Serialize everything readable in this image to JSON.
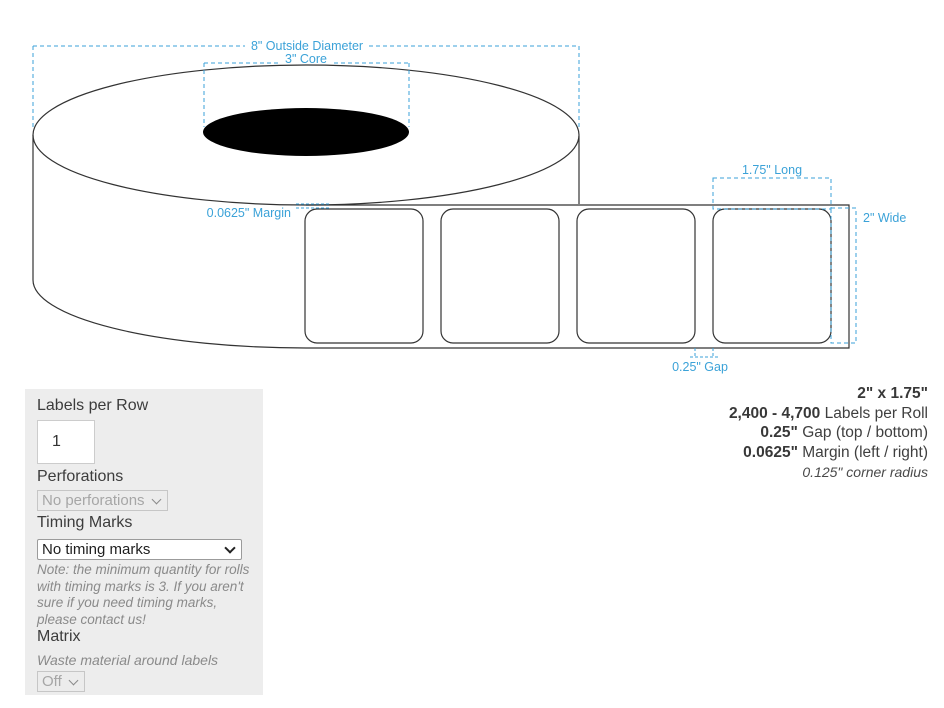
{
  "diagram": {
    "annotations": {
      "outside_diameter": "8\" Outside Diameter",
      "core": "3\" Core",
      "margin": "0.0625\" Margin",
      "length": "1.75\" Long",
      "width": "2\" Wide",
      "gap": "0.25\" Gap"
    },
    "labels_shown": 4,
    "colors": {
      "annotation_blue": "#3ba2d8",
      "outline": "#333333",
      "core_fill": "#000000"
    }
  },
  "form": {
    "labels_per_row_label": "Labels per Row",
    "labels_per_row_value": "1",
    "perforations_label": "Perforations",
    "perforations_value": "No perforations",
    "timing_marks_label": "Timing Marks",
    "timing_marks_value": "No timing marks",
    "timing_note": "Note: the minimum quantity for rolls with timing marks is 3. If you aren't sure if you need timing marks, please contact us!",
    "matrix_label": "Matrix",
    "matrix_description": "Waste material around labels",
    "matrix_value": "Off"
  },
  "specs": {
    "size": "2\" x 1.75\"",
    "per_roll_value": "2,400 - 4,700",
    "per_roll_label": " Labels per Roll",
    "gap_value": "0.25\"",
    "gap_label": " Gap (top / bottom)",
    "margin_value": "0.0625\"",
    "margin_label": " Margin (left / right)",
    "corner_radius": "0.125\" corner radius"
  }
}
